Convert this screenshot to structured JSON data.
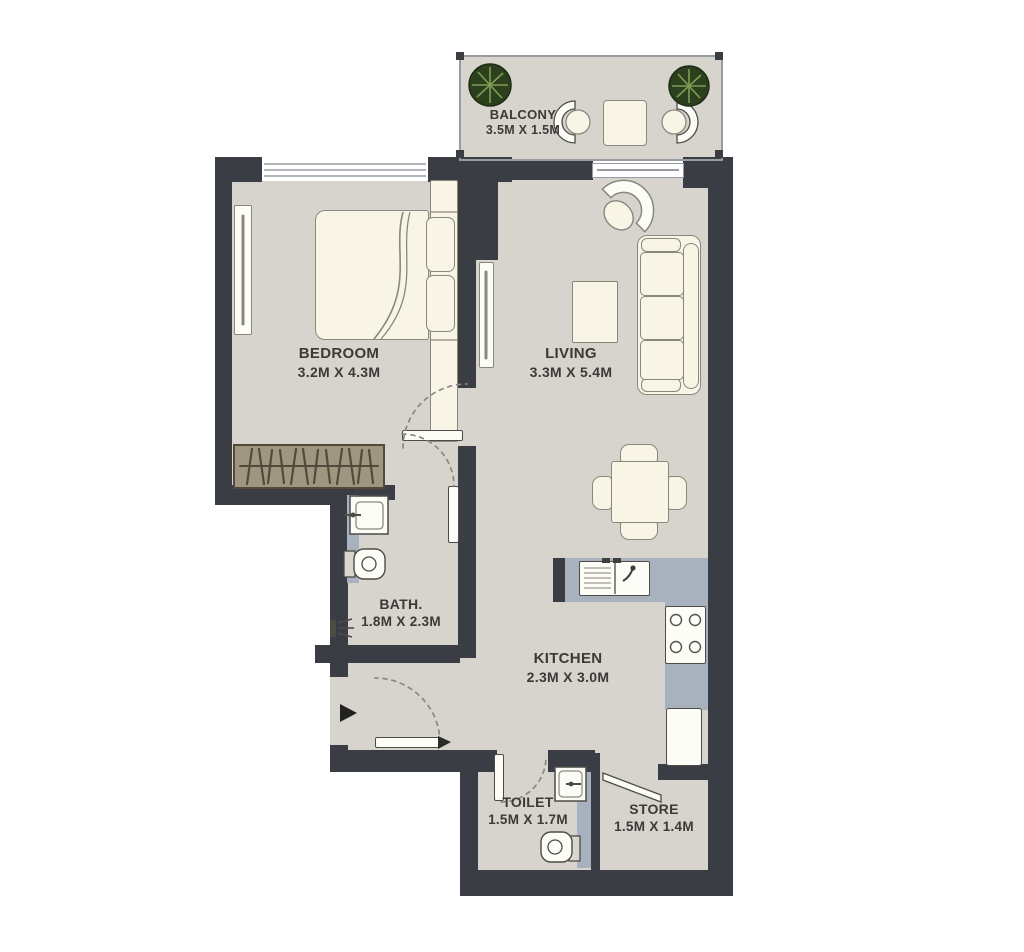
{
  "plan_title": "one-bedroom apartment floor plan",
  "rooms": [
    {
      "id": "balcony",
      "name": "BALCONY",
      "dims": "3.5M X 1.5M"
    },
    {
      "id": "bedroom",
      "name": "BEDROOM",
      "dims": "3.2M X 4.3M"
    },
    {
      "id": "living",
      "name": "LIVING",
      "dims": "3.3M X 5.4M"
    },
    {
      "id": "bath",
      "name": "BATH.",
      "dims": "1.8M X 2.3M"
    },
    {
      "id": "kitchen",
      "name": "KITCHEN",
      "dims": "2.3M X 3.0M"
    },
    {
      "id": "toilet",
      "name": "TOILET",
      "dims": "1.5M X 1.7M"
    },
    {
      "id": "store",
      "name": "STORE",
      "dims": "1.5M X 1.4M"
    }
  ],
  "furniture_icons": [
    "bed",
    "pillow",
    "wardrobe-hangers",
    "bedroom-radiator",
    "living-radiator",
    "armchair",
    "sofa",
    "coffee-table",
    "dining-table",
    "dining-chair",
    "kitchen-sink",
    "stove",
    "fridge",
    "kitchen-counter",
    "bath-washbasin",
    "bath-wc",
    "shower-icon",
    "toilet-washbasin",
    "toilet-wc",
    "balcony-plant",
    "balcony-chair",
    "balcony-table",
    "entry-arrow",
    "door-leaf",
    "door-swing-arc",
    "window",
    "sliding-door"
  ],
  "colors": {
    "wall": "#3a3e44",
    "floor": "#d7d4ce",
    "counter": "#a8b1be",
    "wardrobe": "#9f967f",
    "wardrobe_line": "#55493d",
    "furniture": "#f8f4e6",
    "furniture_line": "#8a877d",
    "fixture": "#fdfdf8",
    "fixture_line": "#4d4b46",
    "plant": "#2c401e",
    "plant_line": "#7f9c55",
    "window_line": "#979ca2",
    "dash": "#8b8880",
    "text": "#3b3a37",
    "arrow": "#222222"
  }
}
